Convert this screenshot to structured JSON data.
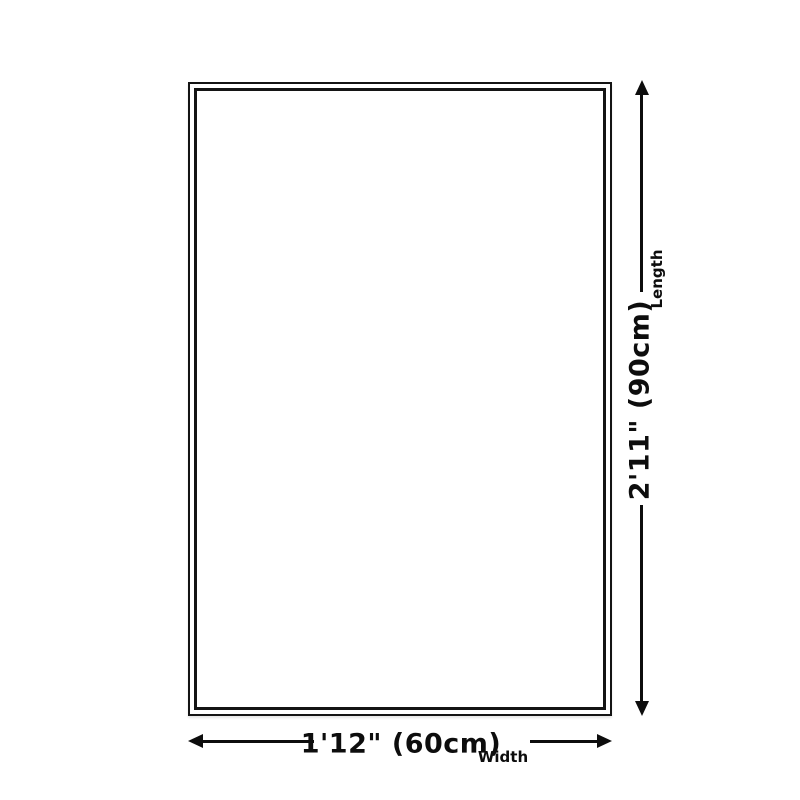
{
  "diagram": {
    "type": "product-size-diagram",
    "shape": "rectangle",
    "colors": {
      "background": "#ffffff",
      "border": "#141414",
      "line": "#0d0d0d",
      "text": "#0d0d0d"
    },
    "length_dimension": {
      "value": "2'11\" (90cm)",
      "label": "Length",
      "orientation": "vertical"
    },
    "width_dimension": {
      "value": "1'12\" (60cm)",
      "label": "Width",
      "orientation": "horizontal"
    }
  }
}
